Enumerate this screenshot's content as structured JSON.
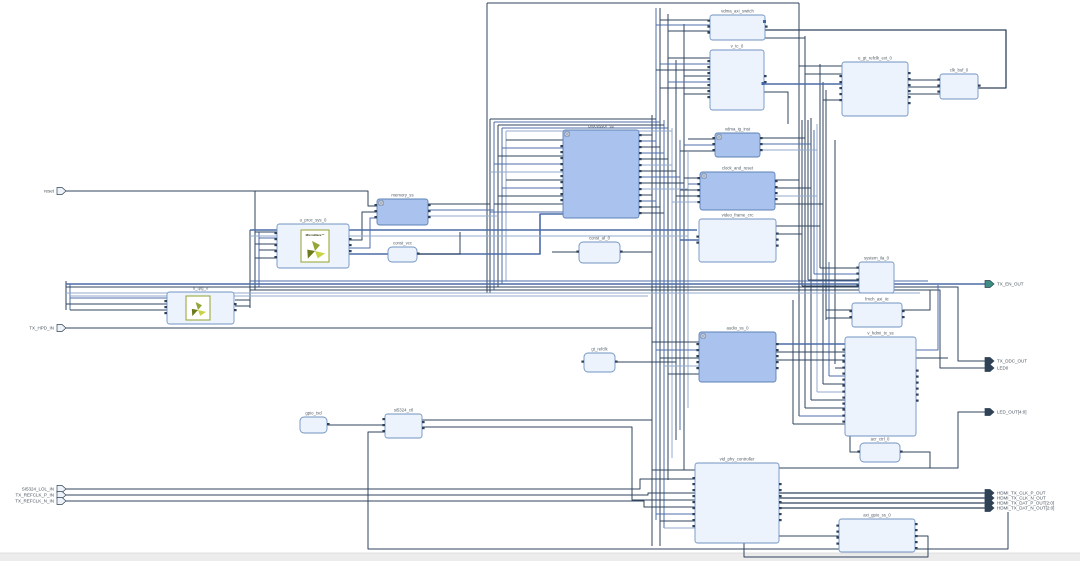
{
  "diagram": {
    "tool_style": "block-design-canvas",
    "colors": {
      "wire_dark": "#30435c",
      "wire_blue": "#4c6ca8",
      "wire_light": "#93aacd",
      "ip_fill": "#edf3fc",
      "ip_border": "#7093c2",
      "hier_fill": "#a9c3ee",
      "hier_border": "#5c80b6",
      "canvas": "#ffffff",
      "bottom_strip": "#ececec",
      "port_dark": "#2f4256"
    },
    "blocks": {
      "vdma_axi_switch": {
        "label": "vdma_axi_switch"
      },
      "v_tc_0": {
        "label": "v_tc_0"
      },
      "u_gt_refclk_ext_0": {
        "label": "u_gt_refclk_ext_0"
      },
      "clk_buf_0": {
        "label": "clk_buf_0"
      },
      "processor_ss": {
        "label": "processor_ss"
      },
      "vdma_ig_inst": {
        "label": "vdma_ig_inst"
      },
      "clock_and_reset": {
        "label": "clock_and_reset"
      },
      "video_frame_crc": {
        "label": "video_frame_crc"
      },
      "memory_ss": {
        "label": "memory_ss"
      },
      "const_vcc": {
        "label": "const_vcc"
      },
      "u_proc_sys_0": {
        "label": "u_proc_sys_0"
      },
      "u_tpg_0": {
        "label": "u_tpg_0"
      },
      "const_af_0": {
        "label": "const_af_0"
      },
      "gt_refclk": {
        "label": "gt_refclk"
      },
      "system_ila_0": {
        "label": "system_ila_0"
      },
      "fmch_axi_iic": {
        "label": "fmch_axi_iic"
      },
      "v_hdmi_tx_ss": {
        "label": "v_hdmi_tx_ss"
      },
      "audio_ss_0": {
        "label": "audio_ss_0"
      },
      "acr_ctrl_0": {
        "label": "acr_ctrl_0"
      },
      "gpio_txd": {
        "label": "gpio_txd"
      },
      "si5324_ctl": {
        "label": "si5324_ctl"
      },
      "vid_phy_controller": {
        "label": "vid_phy_controller"
      },
      "axi_gpio_ss_0": {
        "label": "axi_gpio_ss_0"
      }
    },
    "logo_text": "MicroBlaze™",
    "ports": {
      "left": [
        {
          "label": "reset"
        },
        {
          "label": "TX_HPD_IN"
        },
        {
          "label": "SI5324_LOL_IN"
        },
        {
          "label": "TX_REFCLK_P_IN"
        },
        {
          "label": "TX_REFCLK_N_IN"
        }
      ],
      "right": [
        {
          "label": "TX_EN_OUT"
        },
        {
          "label": "TX_DDC_OUT"
        },
        {
          "label": "LED0"
        },
        {
          "label": "LED_OUT[4:0]"
        },
        {
          "label": "HDMI_TX_CLK_P_OUT"
        },
        {
          "label": "HDMI_TX_CLK_N_OUT"
        },
        {
          "label": "HDMI_TX_DAT_P_OUT[2:0]"
        },
        {
          "label": "HDMI_TX_DAT_N_OUT[2:0]"
        }
      ]
    }
  }
}
